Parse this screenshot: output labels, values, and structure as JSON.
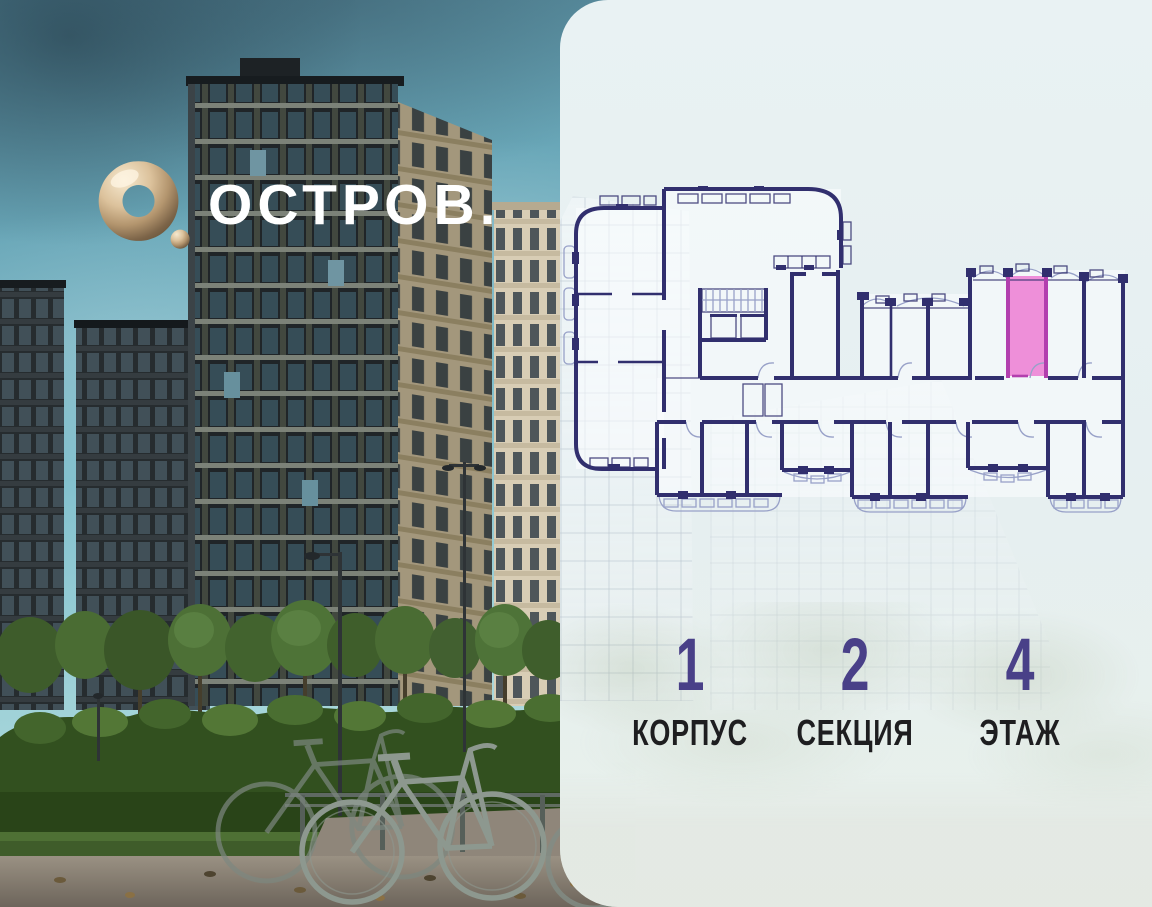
{
  "logo": {
    "ring": "О",
    "dot": ".",
    "text": "ОСТРОВ."
  },
  "panel": {
    "stats": [
      {
        "value": "1",
        "label": "КОРПУС"
      },
      {
        "value": "2",
        "label": "СЕКЦИЯ"
      },
      {
        "value": "4",
        "label": "ЭТАЖ"
      }
    ],
    "floorplan": {
      "highlighted_unit": "studio",
      "highlight_style": "pink"
    }
  },
  "colors": {
    "pink": "#ee8fd9",
    "magenta": "#b23fae",
    "plan": "#312f6e",
    "plan-light": "#98a1c8",
    "panel-bg": "#e6eff1",
    "indigo": "#494088",
    "ink": "#1e1e20",
    "gold-hi": "#f6e9cf",
    "gold-mid": "#cdb188",
    "gold-lo": "#70593d"
  }
}
